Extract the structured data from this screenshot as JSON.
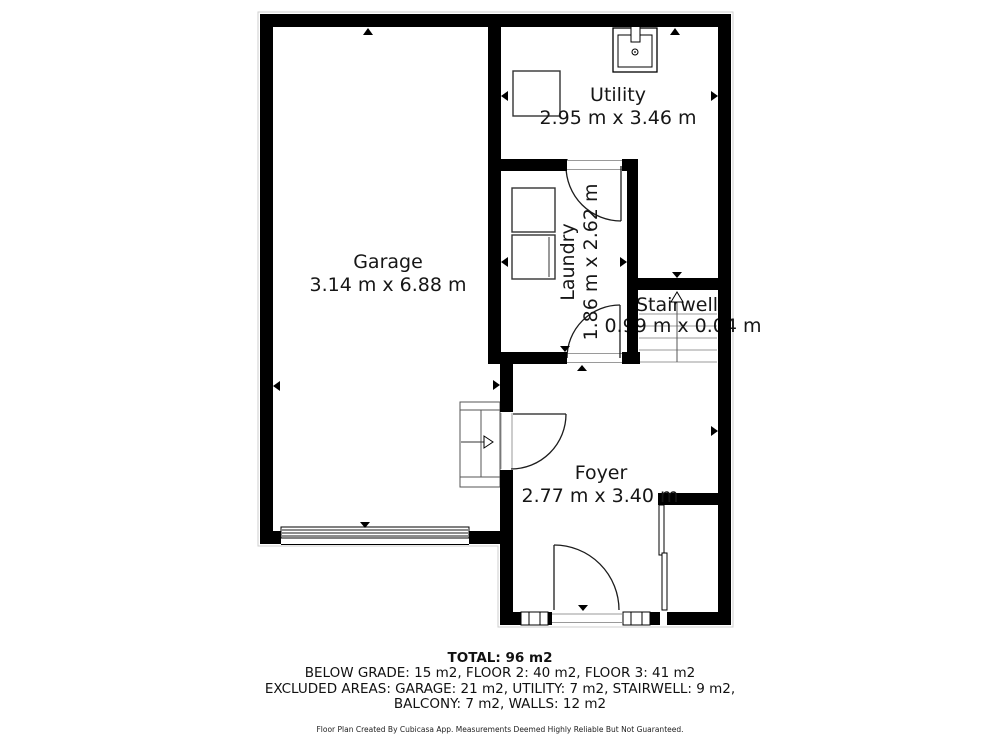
{
  "plan": {
    "rooms": [
      {
        "id": "garage",
        "name": "Garage",
        "dims": "3.14 m x 6.88 m"
      },
      {
        "id": "utility",
        "name": "Utility",
        "dims": "2.95 m x 3.46 m"
      },
      {
        "id": "laundry",
        "name": "Laundry",
        "dims": "1.86 m x 2.62 m"
      },
      {
        "id": "stairwell",
        "name": "Stairwell",
        "dims": "0.99 m x 0.04 m"
      },
      {
        "id": "foyer",
        "name": "Foyer",
        "dims": "2.77 m x 3.40 m"
      }
    ]
  },
  "summary": {
    "total": "TOTAL: 96 m2",
    "line2": "BELOW GRADE: 15 m2, FLOOR 2: 40 m2, FLOOR 3: 41 m2",
    "line3": "EXCLUDED AREAS: GARAGE: 21 m2, UTILITY: 7 m2, STAIRWELL: 9 m2,",
    "line4": "BALCONY: 7 m2, WALLS: 12 m2"
  },
  "footer": {
    "disclaimer": "Floor Plan Created By Cubicasa App. Measurements Deemed Highly Reliable But Not Guaranteed."
  },
  "colors": {
    "wall": "#000000",
    "background": "#ffffff",
    "thin_line": "#9a9a9a",
    "text": "#161616"
  }
}
